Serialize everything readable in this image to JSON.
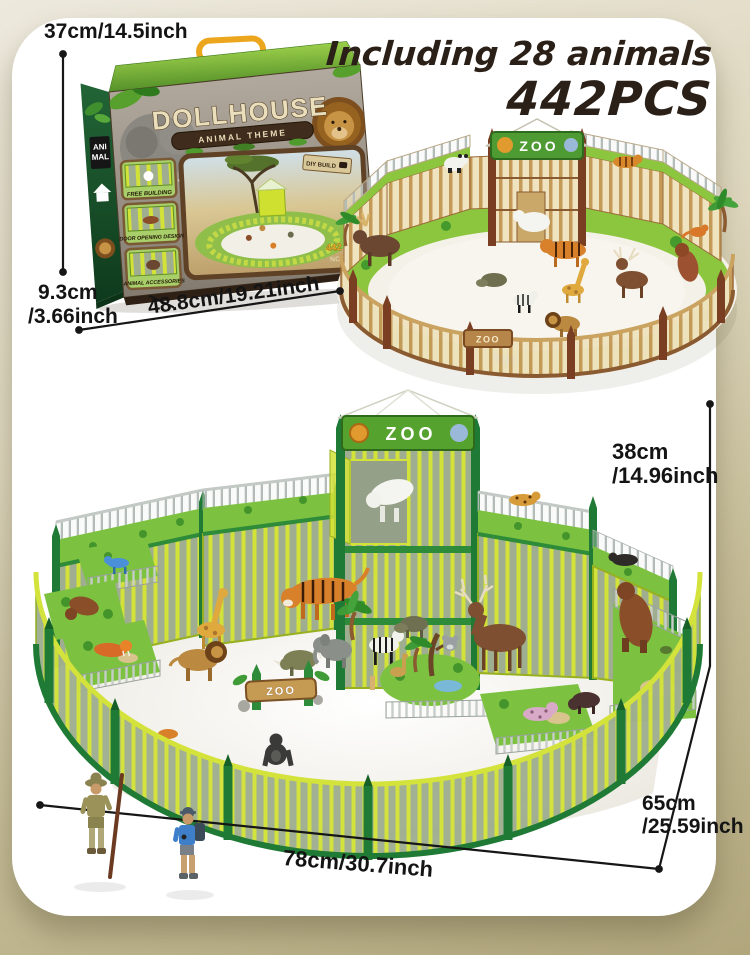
{
  "annotations": {
    "headline": "Including 28 animals",
    "piece_count": "442PCS",
    "box_height": "37cm/14.5inch",
    "box_depth_cm": "9.3cm",
    "box_depth_inch": "/3.66inch",
    "box_width": "48.8cm/19.21inch",
    "set_height_cm": "38cm",
    "set_height_inch": "/14.96inch",
    "set_depth_cm": "65cm",
    "set_depth_inch": "/25.59inch",
    "set_width": "78cm/30.7inch"
  },
  "box": {
    "title": "DOLLHOUSE",
    "subtitle": "ANIMAL THEME",
    "spine_top": "ANI",
    "spine_bottom": "MAL",
    "badge": "DIY BUILD",
    "features": [
      "FREE BUILDING",
      "DOOR OPENING DESIGN",
      "ANIMAL ACCESSORIES"
    ],
    "pieces_label": "442 PC",
    "model_label": "NO.2025"
  },
  "playsets": {
    "zoo_sign": "ZOO",
    "gate_sign": "ZOO"
  },
  "colors": {
    "background_top": "#ede9dd",
    "background_bottom": "#b1a67c",
    "card": "#ffffff",
    "headline_text": "#2b2017",
    "dimension_text": "#141414",
    "green_set_bright": "#d2e238",
    "green_set_dark": "#1e7a34",
    "brown_set_wood": "#efe3c0",
    "brown_set_post": "#7a3f22",
    "grass": "#7cc240"
  }
}
